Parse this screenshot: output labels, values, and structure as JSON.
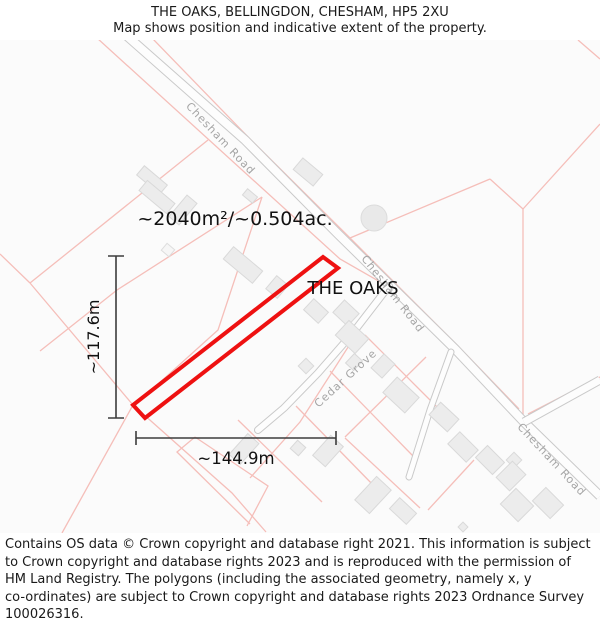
{
  "header": {
    "title": "THE OAKS, BELLINGDON, CHESHAM, HP5 2XU",
    "subtitle": "Map shows position and indicative extent of the property."
  },
  "map": {
    "area_label": "~2040m²/~0.504ac.",
    "property_label": "THE OAKS",
    "width_dimension": "~144.9m",
    "height_dimension": "~117.6m",
    "roads": {
      "chesham_top": "Chesham Road",
      "chesham_mid": "Chesham Road",
      "chesham_bottom": "Chesham Road",
      "cedar_grove": "Cedar Grove"
    },
    "colors": {
      "property_outline": "#ee1111",
      "parcel_boundary": "#f5beb9",
      "road_casing": "#c9c9c9",
      "building_fill": "#ececec",
      "dimension_line": "#3c3c3c",
      "road_label": "#a5a5a5",
      "map_background": "#fbfbfb"
    }
  },
  "footer": {
    "lines": [
      "Contains OS data © Crown copyright and database right 2021. This information is subject",
      "to Crown copyright and database rights 2023 and is reproduced with the permission of",
      "HM Land Registry. The polygons (including the associated geometry, namely x, y",
      "co-ordinates) are subject to Crown copyright and database rights 2023 Ordnance Survey",
      "100026316."
    ]
  }
}
